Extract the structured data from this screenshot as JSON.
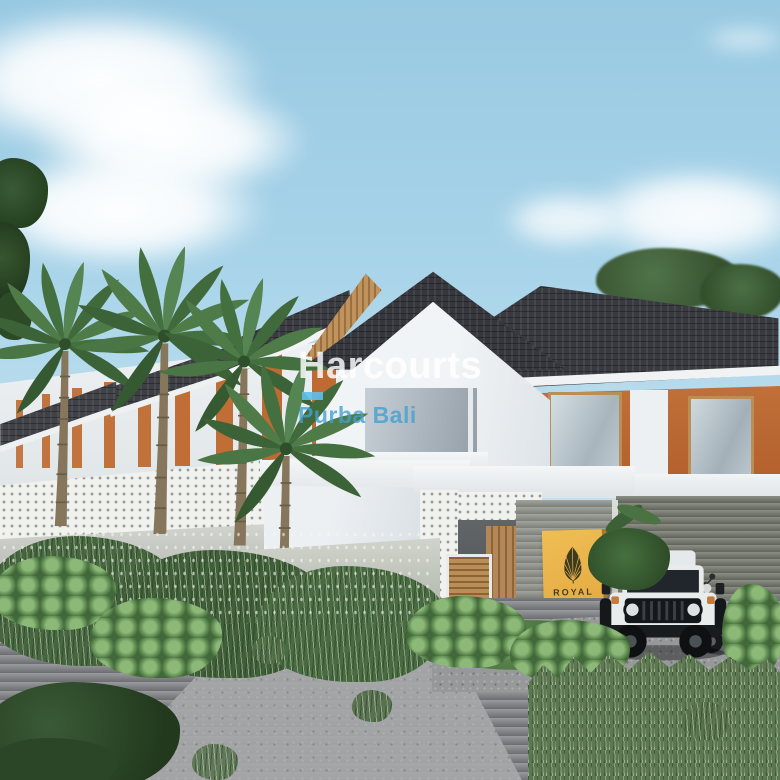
{
  "watermark": {
    "brand": "Harcourts",
    "region": "Purba Bali",
    "brand_color": "#ffffff",
    "region_color": "#42a0cf",
    "accent_bar_color": "#5fc0ea"
  },
  "gate_sign": {
    "title": "ROYAL",
    "subtitle": "RESIDENCE",
    "background_color": "#e9b24a",
    "emblem": "palm-leaf-icon",
    "emblem_color": "#3e3a1f"
  },
  "palette": {
    "sky": "#a9d4e9",
    "cloud": "#ffffff",
    "roof_shingle": "#3a3b41",
    "wall_white": "#eef1f3",
    "accent_orange": "#bf6a33",
    "wood_slat": "#c0935c",
    "breeze_block": "#f1f2ee",
    "gate_wall_gray": "#8e9189",
    "road_gray": "#8e8f91",
    "foliage_dark": "#3f5c3a",
    "foliage_light": "#7fae6d",
    "jeep_white": "#e9eced"
  },
  "scene": {
    "description": "3D architectural rendering of a tropical villa complex: row of white townhouses with orange accent walls and dark shingle roofs, central two-storey gabled house, entrance gate with gold ROYAL sign, palm trees, dense shrubs, white 4x4 jeep and scooter parked by the gate"
  }
}
